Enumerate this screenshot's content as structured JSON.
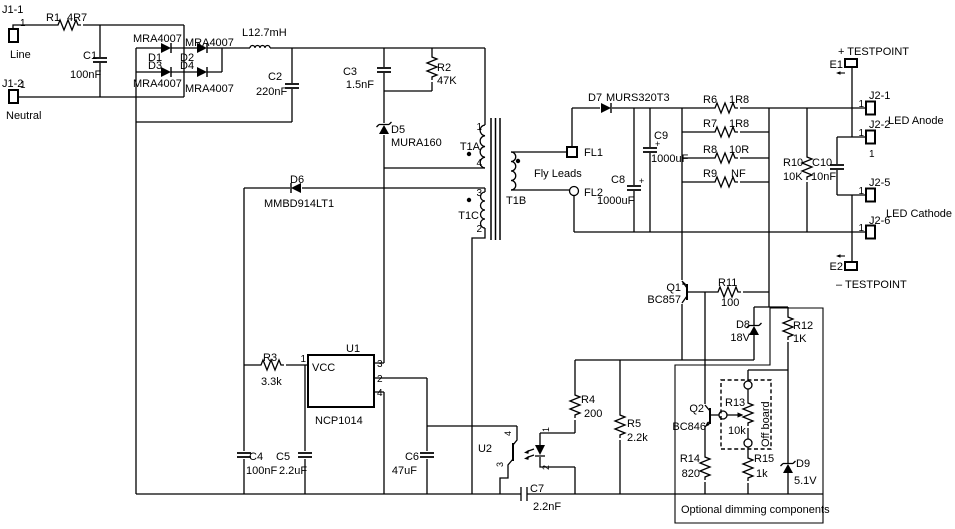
{
  "schematic": {
    "connectors": {
      "j1_1": {
        "ref": "J1-1",
        "pin": "1",
        "name": "Line"
      },
      "j1_2": {
        "ref": "J1-2",
        "pin": "1",
        "name": "Neutral"
      },
      "j2_1": {
        "ref": "J2-1",
        "pin": "1"
      },
      "j2_2": {
        "ref": "J2-2",
        "pin": "1",
        "pin_alt": "1"
      },
      "j2_5": {
        "ref": "J2-5",
        "pin": "1"
      },
      "j2_6": {
        "ref": "J2-6",
        "pin": "1"
      },
      "led_anode": "LED Anode",
      "led_cathode": "LED Cathode"
    },
    "testpoints": {
      "e1": {
        "ref": "E1",
        "label": "+ TESTPOINT"
      },
      "e2": {
        "ref": "E2",
        "label": "– TESTPOINT"
      }
    },
    "resistors": {
      "r1": {
        "ref": "R1",
        "value": "4R7"
      },
      "r2": {
        "ref": "R2",
        "value": "47K"
      },
      "r3": {
        "ref": "R3",
        "value": "3.3k"
      },
      "r4": {
        "ref": "R4",
        "value": "200"
      },
      "r5": {
        "ref": "R5",
        "value": "2.2k"
      },
      "r6": {
        "ref": "R6",
        "value": "1R8"
      },
      "r7": {
        "ref": "R7",
        "value": "1R8"
      },
      "r8": {
        "ref": "R8",
        "value": "10R"
      },
      "r9": {
        "ref": "R9",
        "value": "NF"
      },
      "r10": {
        "ref": "R10",
        "value": "10K"
      },
      "r11": {
        "ref": "R11",
        "value": "100"
      },
      "r12": {
        "ref": "R12",
        "value": "1K"
      },
      "r13": {
        "ref": "R13",
        "value": "10k",
        "note": "Off board"
      },
      "r14": {
        "ref": "R14",
        "value": "820"
      },
      "r15": {
        "ref": "R15",
        "value": "1k"
      }
    },
    "capacitors": {
      "c1": {
        "ref": "C1",
        "value": "100nF"
      },
      "c2": {
        "ref": "C2",
        "value": "220nF"
      },
      "c3": {
        "ref": "C3",
        "value": "1.5nF"
      },
      "c4": {
        "ref": "C4",
        "value": "100nF"
      },
      "c5": {
        "ref": "C5",
        "value": "2.2uF"
      },
      "c6": {
        "ref": "C6",
        "value": "47uF"
      },
      "c7": {
        "ref": "C7",
        "value": "2.2nF"
      },
      "c8": {
        "ref": "C8",
        "value": "1000uF",
        "polarity": "+"
      },
      "c9": {
        "ref": "C9",
        "value": "1000uF",
        "polarity": "+"
      },
      "c10": {
        "ref": "C10",
        "value": "10nF"
      }
    },
    "diodes": {
      "d1": {
        "ref": "D1",
        "part": "MRA4007"
      },
      "d2": {
        "ref": "D2",
        "part": "MRA4007"
      },
      "d3": {
        "ref": "D3",
        "part": "MRA4007"
      },
      "d4": {
        "ref": "D4",
        "part": "MRA4007"
      },
      "d5": {
        "ref": "D5",
        "part": "MURA160"
      },
      "d6": {
        "ref": "D6",
        "part": "MMBD914LT1"
      },
      "d7": {
        "ref": "D7",
        "part": "MURS320T3"
      },
      "d8": {
        "ref": "D8",
        "value": "18V"
      },
      "d9": {
        "ref": "D9",
        "value": "5.1V"
      }
    },
    "inductor": {
      "label": "L12.7mH"
    },
    "transistors": {
      "q1": {
        "ref": "Q1",
        "part": "BC857"
      },
      "q2": {
        "ref": "Q2",
        "part": "BC846"
      }
    },
    "ics": {
      "u1": {
        "ref": "U1",
        "part": "NCP1014",
        "supply_pin": "VCC",
        "pins": {
          "p1": "1",
          "p2": "2",
          "p3": "3",
          "p4": "4"
        }
      },
      "u2": {
        "ref": "U2",
        "pins": {
          "p1": "1",
          "p2": "2",
          "p3": "3",
          "p4": "4"
        }
      }
    },
    "transformer": {
      "t1a": "T1A",
      "t1b": "T1B",
      "t1c": "T1C",
      "pins": {
        "p1": "1",
        "p2": "2",
        "p3": "3",
        "p4": "4"
      },
      "fl1": "FL1",
      "fl2": "FL2",
      "fly_leads": "Fly Leads"
    },
    "notes": {
      "optional_dimming": "Optional dimming components"
    }
  }
}
